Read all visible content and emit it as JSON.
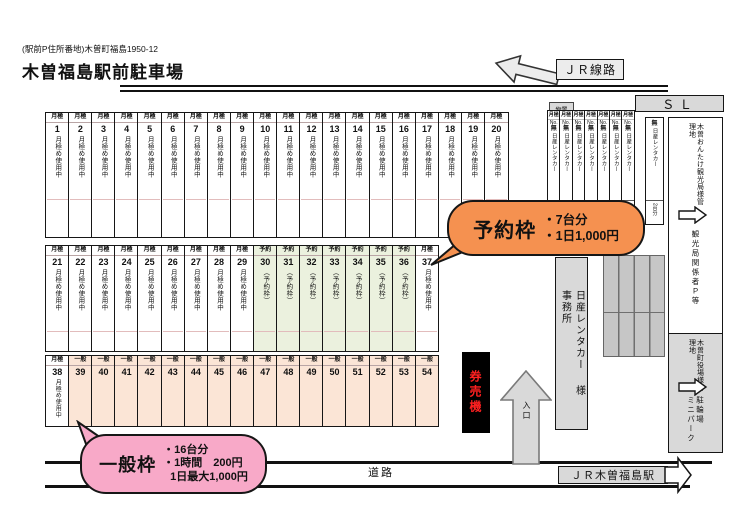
{
  "header": {
    "address": "(駅前P住所番地)木曽町福島1950-12",
    "title": "木曽福島駅前駐車場"
  },
  "top": {
    "jr_line_label": "ＪＲ線路",
    "sl_label": "ＳＬ",
    "storage_label": "物置"
  },
  "cell_types": {
    "m": {
      "header": "月極",
      "label": "月極め使用中",
      "bg": "#ffffff"
    },
    "r": {
      "header": "予約",
      "label": "（予約枠）",
      "bg": "#ebf1de"
    },
    "g": {
      "header": "一般",
      "label": "",
      "bg": "#fbe5d6"
    }
  },
  "parking_rows": [
    {
      "segments": [
        {
          "from": 1,
          "to": 20,
          "type": "m"
        }
      ]
    },
    {
      "segments": [
        {
          "from": 21,
          "to": 29,
          "type": "m"
        },
        {
          "from": 30,
          "to": 36,
          "type": "r"
        },
        {
          "from": 37,
          "to": 37,
          "type": "m"
        }
      ]
    },
    {
      "segments": [
        {
          "from": 38,
          "to": 38,
          "type": "m"
        },
        {
          "from": 39,
          "to": 54,
          "type": "g"
        }
      ]
    }
  ],
  "rental_block": {
    "count": 7,
    "header": "月極",
    "no_label": "No.",
    "vacant": "無",
    "company": "日産レンタカー",
    "capacity": "2台分"
  },
  "rental_side": {
    "vacant": "無",
    "company": "日産レンタカー",
    "capacity": "2台分"
  },
  "right_zone": {
    "top": {
      "manager_line1": "木曽おんたけ観光局様管",
      "manager_line2": "理地",
      "area": "観光局関係者Ｐ等"
    },
    "bottom": {
      "manager_line1": "木曽町役場様管",
      "manager_line2": "理地",
      "area_line1": "駐輪場",
      "area_line2": "ミニパーク"
    }
  },
  "office": {
    "line1": "日産レンタカー",
    "suffix": "様",
    "line2": "事務所"
  },
  "facilities": {
    "ticket_machine": "券売機",
    "entrance": "入口"
  },
  "callouts": {
    "reserved": {
      "title": "予約枠",
      "line1": "・7台分",
      "line2": "・1日1,000円",
      "color": "#f59150"
    },
    "general": {
      "title": "一般枠",
      "line1": "・16台分",
      "line2": "・1時間　200円",
      "line3": "1日最大1,000円",
      "color": "#f8a9c8"
    }
  },
  "bottom": {
    "road_label": "道路",
    "station_label": "ＪＲ木曽福島駅"
  }
}
